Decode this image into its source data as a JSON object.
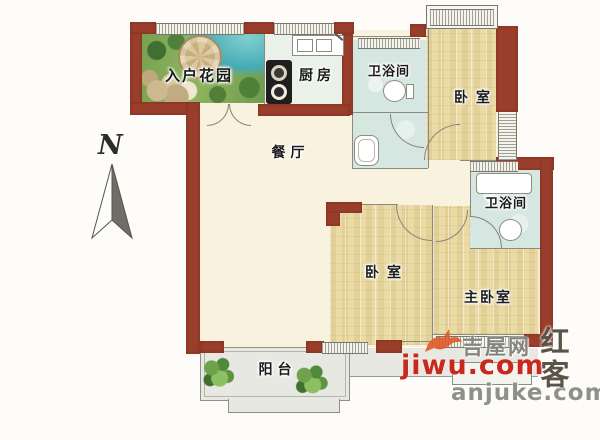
{
  "plan": {
    "compass_label": "N",
    "rooms": [
      {
        "id": "entry-garden",
        "label": "入户花园"
      },
      {
        "id": "kitchen",
        "label": "厨房"
      },
      {
        "id": "bath-top",
        "label": "卫浴间"
      },
      {
        "id": "bedroom-top",
        "label": "卧室"
      },
      {
        "id": "dining",
        "label": "餐厅"
      },
      {
        "id": "bath-mid",
        "label": "卫浴间"
      },
      {
        "id": "bedroom-mid",
        "label": "卧室"
      },
      {
        "id": "master-bedroom",
        "label": "主卧室"
      },
      {
        "id": "balcony",
        "label": "阳台"
      }
    ]
  },
  "watermarks": {
    "jiwu_site": "吉屋网",
    "jiwu_domain": "jiwu.com",
    "anjuke_domain": "anjuke.com",
    "stamp_text": "红客"
  },
  "colors": {
    "wall": "#9a3e2c",
    "floor_cream": "#f8f2de",
    "floor_wood": "#eee0ab",
    "floor_bath": "#d6e7e1",
    "floor_balcony": "#e8e8e3",
    "watermark_red": "#c8291c",
    "watermark_gray": "#8f9088"
  }
}
